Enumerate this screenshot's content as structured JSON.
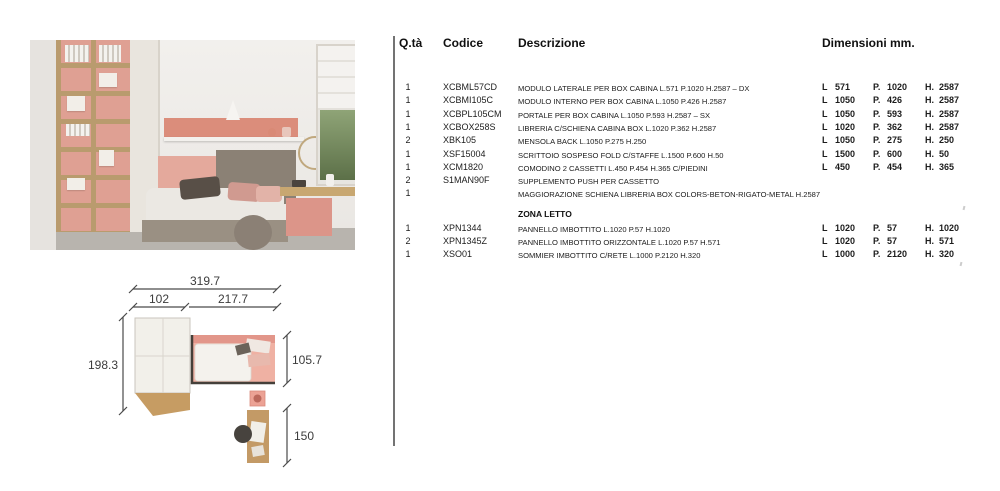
{
  "palette": {
    "coral": "#db8d7b",
    "soft_pink": "#e4a99c",
    "wood": "#bf9e6c",
    "taupe": "#8b8175",
    "wall": "#efedea",
    "floor_gray": "#b8b4ae",
    "ink": "#1c1c1c"
  },
  "table": {
    "headers": {
      "qty": "Q.tà",
      "code": "Codice",
      "description": "Descrizione",
      "dimensions": "Dimensioni mm."
    },
    "dim_l_label": "L",
    "dim_p_label": "P.",
    "dim_h_label": "H.",
    "section2_title": "ZONA LETTO",
    "rows1": [
      {
        "qty": "1",
        "code": "XCBML57CD",
        "desc": "MODULO LATERALE PER BOX CABINA L.571 P.1020 H.2587 – DX",
        "l": "571",
        "p": "1020",
        "h": "2587"
      },
      {
        "qty": "1",
        "code": "XCBMI105C",
        "desc": "MODULO INTERNO PER BOX CABINA L.1050 P.426 H.2587",
        "l": "1050",
        "p": "426",
        "h": "2587"
      },
      {
        "qty": "1",
        "code": "XCBPL105CM",
        "desc": "PORTALE PER BOX CABINA L.1050 P.593 H.2587 – SX",
        "l": "1050",
        "p": "593",
        "h": "2587"
      },
      {
        "qty": "1",
        "code": "XCBOX258S",
        "desc": "LIBRERIA C/SCHIENA CABINA BOX L.1020 P.362 H.2587",
        "l": "1020",
        "p": "362",
        "h": "2587"
      },
      {
        "qty": "2",
        "code": "XBK105",
        "desc": "MENSOLA BACK L.1050 P.275 H.250",
        "l": "1050",
        "p": "275",
        "h": "250"
      },
      {
        "qty": "1",
        "code": "XSF15004",
        "desc": "SCRITTOIO SOSPESO FOLD C/STAFFE L.1500 P.600 H.50",
        "l": "1500",
        "p": "600",
        "h": "50"
      },
      {
        "qty": "1",
        "code": "XCM1820",
        "desc": "COMODINO 2 CASSETTI L.450 P.454 H.365 C/PIEDINI",
        "l": "450",
        "p": "454",
        "h": "365"
      },
      {
        "qty": "2",
        "code": "S1MAN90F",
        "desc": "SUPPLEMENTO PUSH PER CASSETTO"
      },
      {
        "qty": "1",
        "code": "",
        "desc": "MAGGIORAZIONE SCHIENA LIBRERIA BOX COLORS-BETON-RIGATO-METAL H.2587"
      }
    ],
    "rows2": [
      {
        "qty": "1",
        "code": "XPN1344",
        "desc": "PANNELLO IMBOTTITO L.1020 P.57 H.1020",
        "l": "1020",
        "p": "57",
        "h": "1020"
      },
      {
        "qty": "2",
        "code": "XPN1345Z",
        "desc": "PANNELLO IMBOTTITO ORIZZONTALE L.1020 P.57 H.571",
        "l": "1020",
        "p": "57",
        "h": "571"
      },
      {
        "qty": "1",
        "code": "XSO01",
        "desc": "SOMMIER IMBOTTITO C/RETE L.1000 P.2120 H.320",
        "l": "1000",
        "p": "2120",
        "h": "320"
      }
    ]
  },
  "drawing": {
    "total_width": "319.7",
    "width_left": "102",
    "width_right": "217.7",
    "height_total": "198.3",
    "bed_depth": "105.7",
    "desk_depth": "150"
  }
}
